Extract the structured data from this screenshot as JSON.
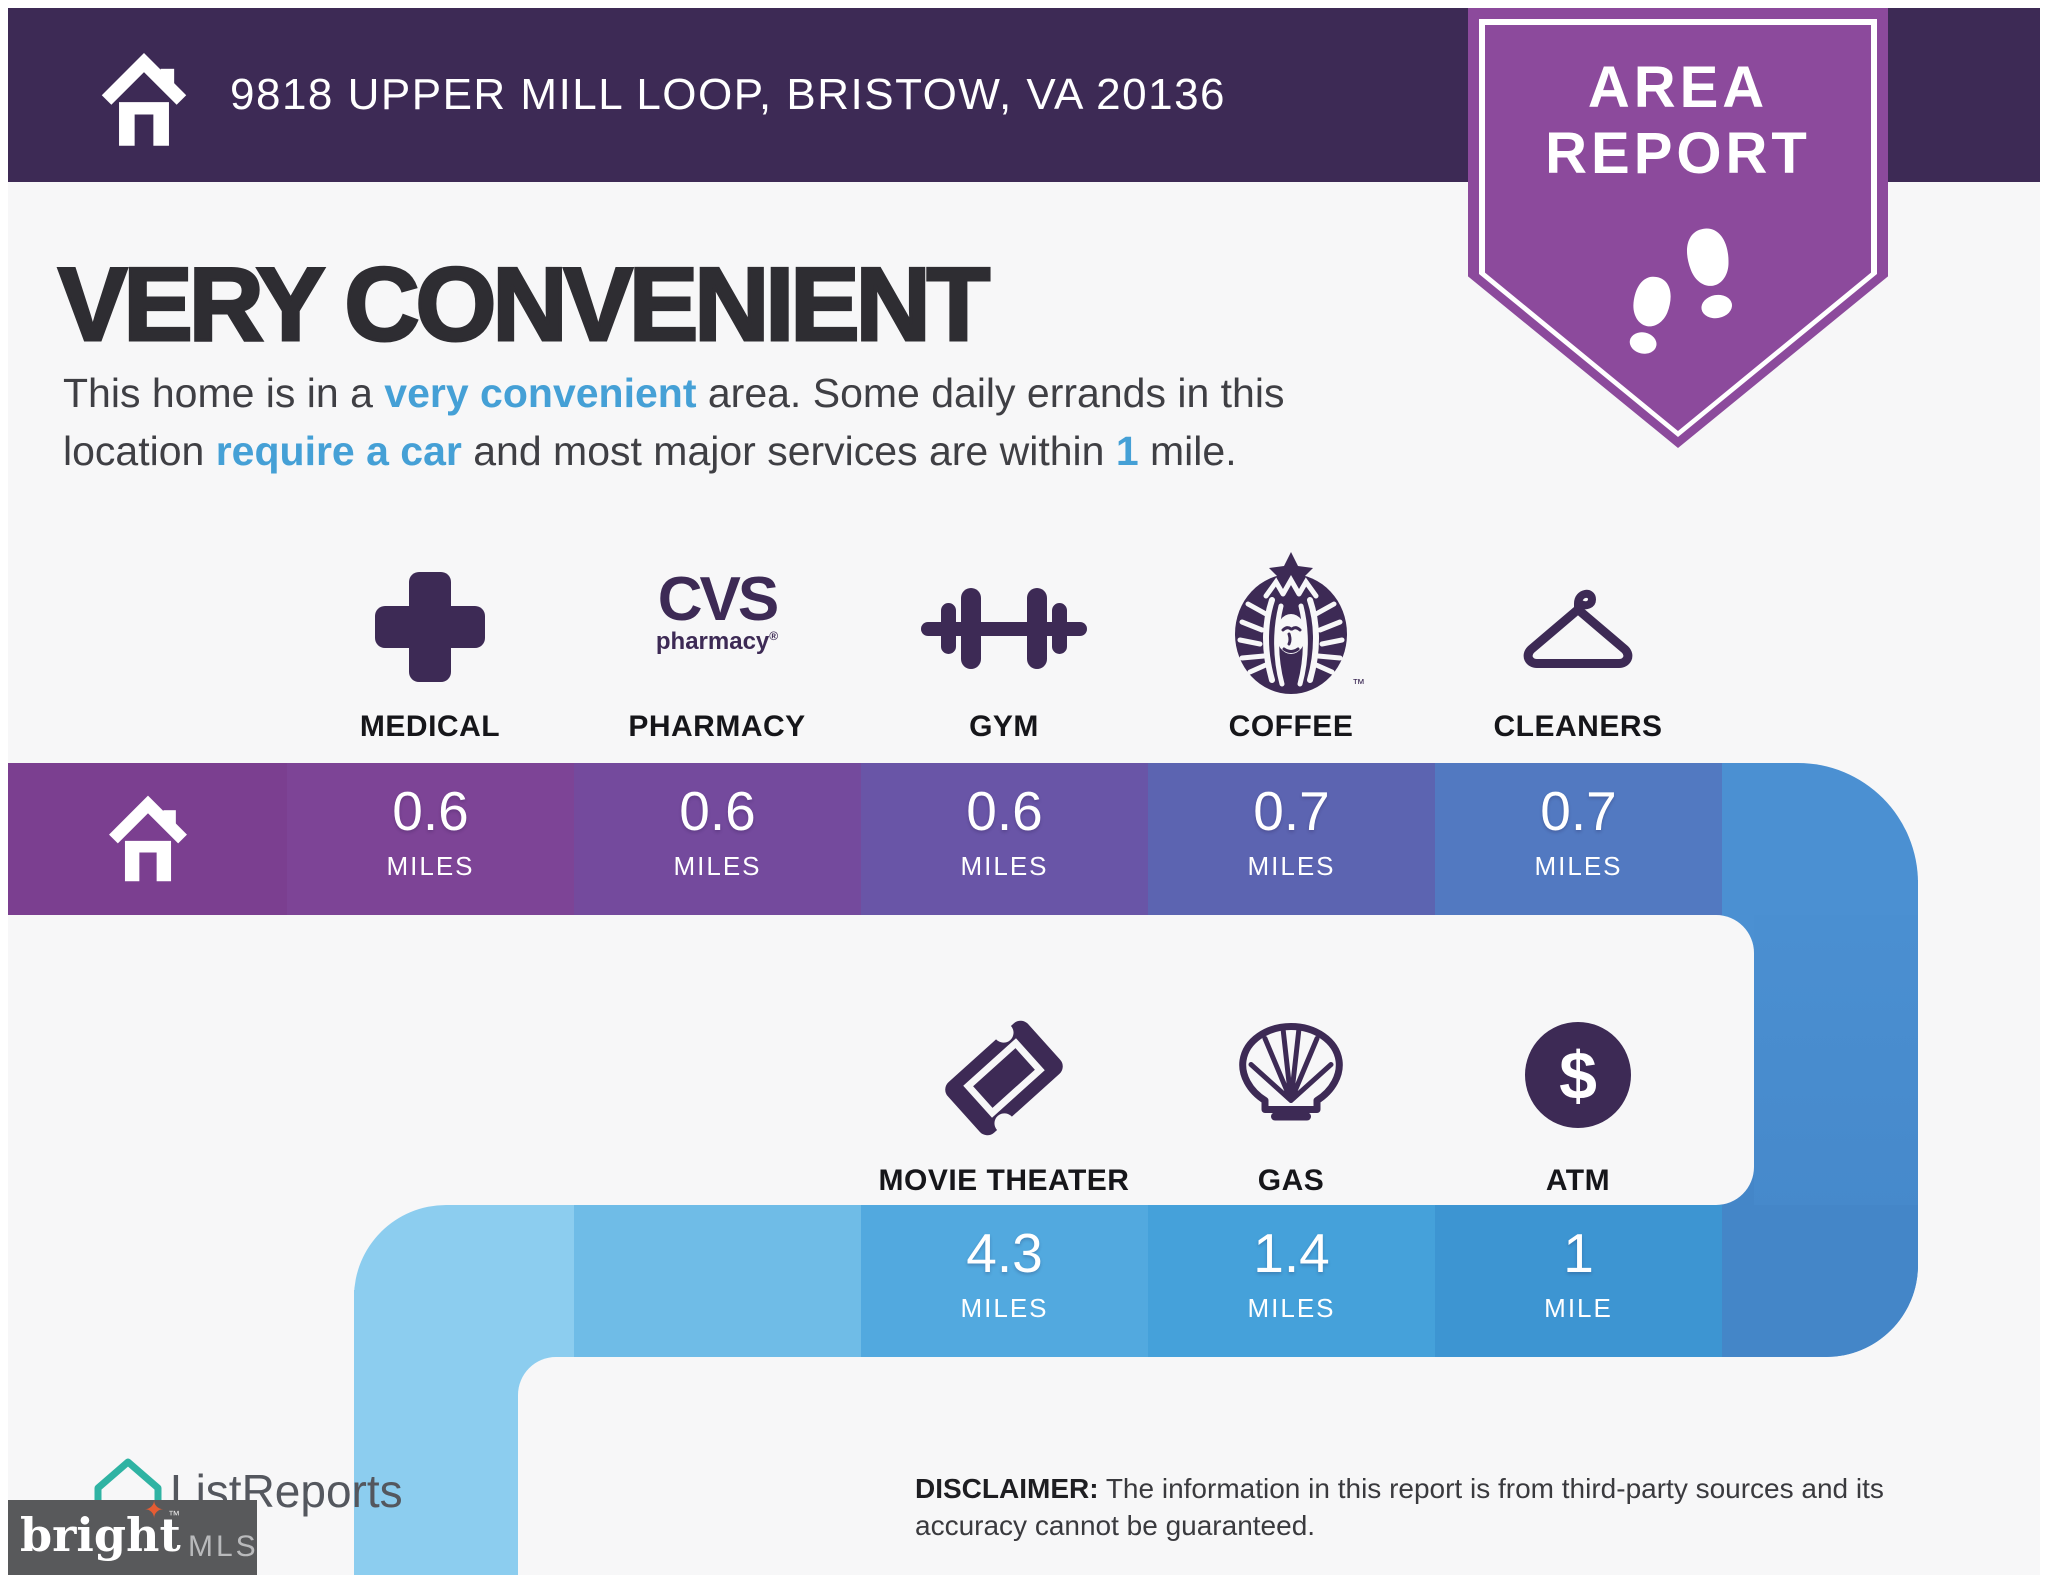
{
  "header": {
    "address": "9818 UPPER MILL LOOP, BRISTOW, VA 20136"
  },
  "badge": {
    "line1": "AREA",
    "line2": "REPORT"
  },
  "headline": "VERY CONVENIENT",
  "description": {
    "lines": [
      {
        "segments": [
          {
            "t": "This home is in a ",
            "h": false
          },
          {
            "t": "very convenient",
            "h": true
          },
          {
            "t": " area. Some daily errands in this",
            "h": false
          }
        ]
      },
      {
        "segments": [
          {
            "t": "location ",
            "h": false
          },
          {
            "t": "require a car",
            "h": true
          },
          {
            "t": " and most major services are within ",
            "h": false
          },
          {
            "t": "1",
            "h": true
          },
          {
            "t": " mile.",
            "h": false
          }
        ]
      }
    ]
  },
  "row1": {
    "items": [
      {
        "label": "MEDICAL",
        "icon": "medical-cross-icon",
        "distance": "0.6",
        "unit": "MILES",
        "color": "#7d4496"
      },
      {
        "label": "PHARMACY",
        "icon": "cvs-pharmacy-logo",
        "logo_main": "CVS",
        "logo_sub": "pharmacy",
        "reg": "®",
        "distance": "0.6",
        "unit": "MILES",
        "color": "#744a9d"
      },
      {
        "label": "GYM",
        "icon": "dumbbell-icon",
        "distance": "0.6",
        "unit": "MILES",
        "color": "#6955a7"
      },
      {
        "label": "COFFEE",
        "icon": "starbucks-siren-logo",
        "tm": "™",
        "distance": "0.7",
        "unit": "MILES",
        "color": "#5c64b1"
      },
      {
        "label": "CLEANERS",
        "icon": "hanger-icon",
        "distance": "0.7",
        "unit": "MILES",
        "color": "#5279c1"
      }
    ],
    "home_color": "#7b3f90",
    "tail_color": "#4b90d2"
  },
  "row2": {
    "items": [
      {
        "label": "MOVIE THEATER",
        "icon": "ticket-icon",
        "distance": "4.3",
        "unit": "MILES",
        "color": "#52a9df"
      },
      {
        "label": "GAS",
        "icon": "shell-gas-logo",
        "distance": "1.4",
        "unit": "MILES",
        "color": "#45a1da"
      },
      {
        "label": "ATM",
        "icon": "dollar-circle-icon",
        "symbol": "$",
        "distance": "1",
        "unit": "MILE",
        "color": "#3d95d2"
      }
    ],
    "curve_color": "#8ccdef",
    "lead_color": "#6fbce7",
    "column_color": "#4486c8"
  },
  "footer": {
    "listreports": "ListReports",
    "disclaimer_label": "DISCLAIMER:",
    "disclaimer_text": "The information in this report is from third-party sources and its accuracy cannot be guaranteed.",
    "brightmls": {
      "word": "bright",
      "tm": "™",
      "suffix": "MLS"
    }
  },
  "colors": {
    "page_bg": "#f7f7f8",
    "header_bg": "#3d2a55",
    "badge_purple": "#8c4a9c",
    "icon_purple": "#3d2a55",
    "highlight_blue": "#45a0d6",
    "headline_text": "#2e2d32",
    "body_text": "#3f3f44",
    "home_cell": "#7b3f90",
    "row1_tail": "#4b90d2",
    "row2_column": "#4486c8",
    "row2_curve": "#8ccdef",
    "brightmls_bg": "#58595b",
    "brightmls_orange": "#e65c33",
    "listreports_teal": "#2fb3a3"
  }
}
